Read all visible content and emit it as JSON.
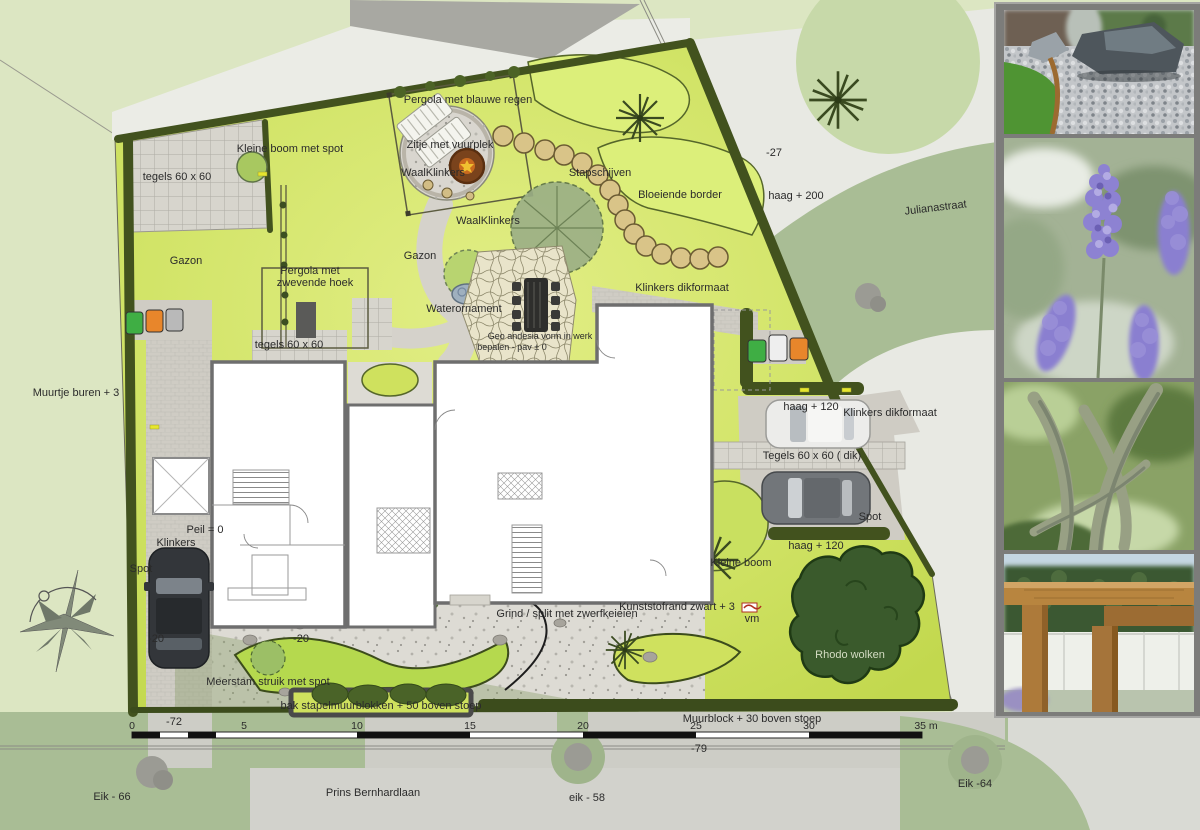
{
  "labels": {
    "pergola_blauwe_regen": "Pergola met blauwe regen",
    "kleine_boom_spot": "Kleine boom met spot",
    "tegels_60_top": "tegels 60 x 60",
    "zitje_vuurplek": "Zitje met vuurplek",
    "waalklinkers_a": "WaalKlinkers",
    "waalklinkers_b": "WaalKlinkers",
    "stapschijven": "Stapschijven",
    "bloeiende_border": "Bloeiende border",
    "haag_200": "haag + 200",
    "min27": "-27",
    "julianastraat": "Julianastraat",
    "gazon_a": "Gazon",
    "gazon_b": "Gazon",
    "pergola_zwevend_1": "Pergola met",
    "pergola_zwevend_2": "zwevende hoek",
    "waterornament": "Waterornament",
    "klinkers_dik_a": "Klinkers dikformaat",
    "tegels_60_mid": "tegels 60 x 60",
    "geo_1": "Geo andesia vorm in werk",
    "geo_2": "bepalen - pav ± 0",
    "muurtje_buren": "Muurtje buren + 3",
    "haag_120_a": "haag + 120",
    "klinkers_dik_b": "Klinkers dikformaat",
    "tegels_60_dik": "Tegels 60 x 60 ( dik)",
    "spot_a": "Spot",
    "haag_120_b": "haag + 120",
    "kleine_boom": "Kleine boom",
    "peil_0": "Peil = 0",
    "klinkers": "Klinkers",
    "spot_b": "Spot",
    "kunststofrand": "Kunststofrand zwart + 3",
    "vm": "vm",
    "grind_split": "Grind / split met zwerfkeieien",
    "rhodo_wolken": "Rhodo wolken",
    "min20_a": "-20",
    "min20_b": "-20",
    "meerstam": "Meerstam struik met spot",
    "bak_stapel": "bak stapelmuurblokken  + 50 boven stoep",
    "muurblock": "Muurblock + 30 boven stoep",
    "min72": "-72",
    "min79": "-79"
  },
  "scalebar": {
    "ticks": [
      "0",
      "5",
      "10",
      "15",
      "20",
      "25",
      "30",
      "35 m"
    ]
  },
  "streets": {
    "bottom": "Prins Bernhardlaan",
    "right": "Julianastraat"
  },
  "trees_named": {
    "eik_66": "Eik - 66",
    "eik_58": "eik - 58",
    "eik_64": "Eik -64"
  },
  "photos": [
    {
      "name": "gravel-garden-with-boulders"
    },
    {
      "name": "lavender-flowers"
    },
    {
      "name": "multi-stem-tree"
    },
    {
      "name": "wooden-pergola-beams"
    }
  ],
  "colors": {
    "lawn_bright": "#cfe160",
    "hedge_dark": "#42521e",
    "paving_gray": "#cfccc4",
    "street_sage": "#a9bd95",
    "spot_yellow": "#e6e62e"
  }
}
